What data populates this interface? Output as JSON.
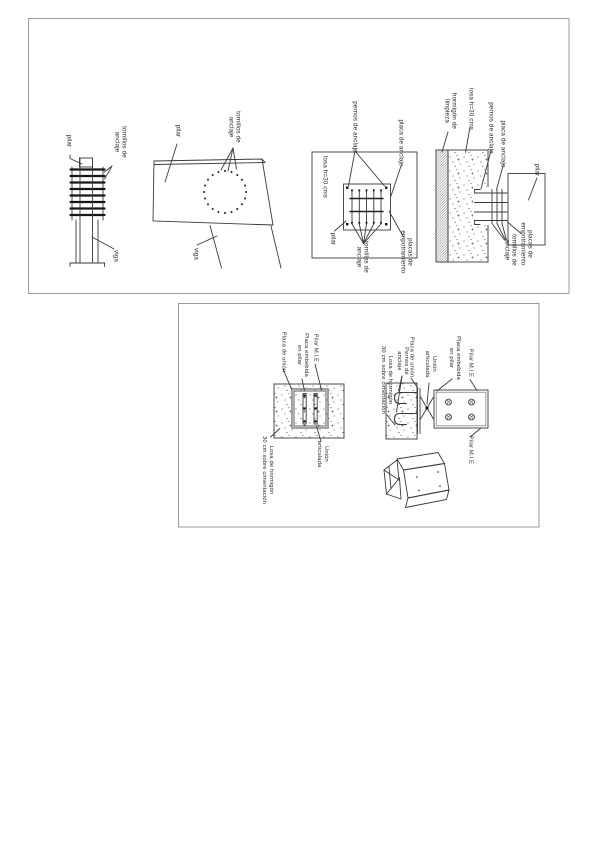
{
  "sheet": {
    "border_color": "#8f8f8f",
    "line_color": "#3a3a3a",
    "text_color": "#2b2b2b",
    "panels": {
      "anchor_details": {
        "column_elevation": {
          "labels": {
            "pilar": "pilar",
            "tornillos": "tornillos de\nanclaje",
            "viga": "viga"
          }
        },
        "column_front": {
          "labels": {
            "pilar": "pilar",
            "tornillos": "tornillos de\nanclaje",
            "viga": "viga"
          }
        },
        "base_plan": {
          "labels": {
            "pernos": "pernos de anclaje",
            "placa": "placa de anclaje",
            "losa": "losa h=30 cms",
            "pilar": "pilar",
            "tornillos": "tornillos de\nanclaje",
            "placas_emp": "placas de\nempotramiento"
          }
        },
        "base_section": {
          "labels": {
            "hormigon": "hormigón de\nlimpieza",
            "losa": "losa h=30 cms",
            "pernos": "pernos de anclaje",
            "placa": "placa de anclaje",
            "pilar": "pilar",
            "tornillos": "tornillos de\nanclaje",
            "placas_emp": "placas de\nempotramiento"
          }
        }
      },
      "pinned_details": {
        "plan": {
          "labels": {
            "placa_union": "Placa de unión",
            "placa_embebida": "Placa embebida\nen pilar",
            "pilar_mie": "Pilar M.I.E",
            "union": "Unión\narticulada",
            "losa": "Losa de hormigón\n30 cm sobre cimentación"
          }
        },
        "section": {
          "labels": {
            "losa": "Losa de hormigón\n30 cm sobre cimentación",
            "pernos": "Pernos de\nanclaje",
            "placa_union": "Placa de unión",
            "union": "Unión\narticulada",
            "placa_embebida": "Placa embebida\nen pilar",
            "pilar_top": "Pilar M.I.E",
            "pilar_bottom": "Pilar M.I.E"
          }
        }
      }
    }
  }
}
